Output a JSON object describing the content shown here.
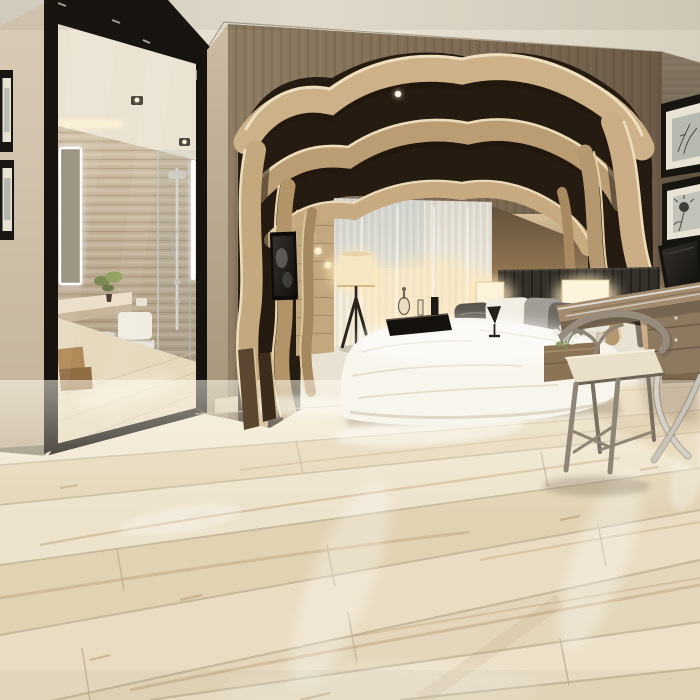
{
  "scene": {
    "type": "interior-photograph",
    "description": "Modern hotel-style bedroom showcasing wide light-oak plank flooring, with a sculptural layered wood arch framing the bed alcove, a black-framed opening revealing an en-suite bathroom, a wooden writing desk with laptop and wishbone chair, and warm accent lighting",
    "room": "bedroom with en-suite bathroom view",
    "style": "contemporary organic wood design",
    "lighting": [
      "warm recessed ceiling downlights",
      "glowing rectangular bedside lamps",
      "tripod floor lamp with fabric shade",
      "LED backlit bathroom mirror",
      "vertical LED strip in shower area"
    ],
    "palette": {
      "ceiling": "#e8e1d2",
      "left_wall": "#cdbfa8",
      "wood_feature_wall": "#83705a",
      "right_wall": "#675b4c",
      "arch_wood_light": "#c9ad85",
      "arch_wood_mid": "#b29468",
      "arch_void_dark": "#261b10",
      "arch_edge_highlight": "#eee0bf",
      "mirror_frame_black": "#17130f",
      "bathroom_travertine": "#bfae94",
      "bathroom_ceiling": "#ebe3d2",
      "curtain_sheer": "#efe8da",
      "headboard_charcoal": "#34302a",
      "bedding_white": "#f8f5ed",
      "lamp_glow_warm": "#fdf3d9",
      "desk_wood": "#a28b6e",
      "chair_wood_taupe": "#8f8577",
      "chrome_metal": "#d6d2ca",
      "floor_plank_light": "#efe6d0",
      "floor_plank_tan": "#e1d2b2",
      "floor_grain": "#ab8d62",
      "floor_seam": "#c3b69a"
    },
    "floor": {
      "material": "wide-plank wood-look flooring, glossy finish",
      "plank_direction": "diagonal, rising toward right vanishing point",
      "visible_seams": 8,
      "visible_end_joints": 8
    },
    "objects": [
      {
        "name": "framed-wall-art-left",
        "count": 2,
        "note": "black frames, cream mats, clipped at left edge"
      },
      {
        "name": "mirror-doorway-to-bathroom",
        "note": "tall black-framed opening"
      },
      {
        "name": "bathroom-vanity",
        "note": "cream stone counter"
      },
      {
        "name": "potted-plant",
        "note": "small green bonsai on counter"
      },
      {
        "name": "toilet",
        "note": "white, wall side"
      },
      {
        "name": "pedal-trash-can",
        "note": "stainless steel"
      },
      {
        "name": "walk-in-shower",
        "note": "glass panel, chrome shower column"
      },
      {
        "name": "led-mirror",
        "note": "glowing white outline"
      },
      {
        "name": "sculptural-wood-arch",
        "note": "nested wavy timber ribbons around bed alcove"
      },
      {
        "name": "sheer-curtain",
        "note": "backlit warm white"
      },
      {
        "name": "tripod-floor-lamp",
        "note": "beige glowing shade, black legs"
      },
      {
        "name": "wall-tv",
        "note": "small dark screen on arch leg"
      },
      {
        "name": "wall-sconces",
        "count": 3,
        "note": "tiny glowing lamps on padded column"
      },
      {
        "name": "bed-with-white-duvet",
        "note": "low platform bed"
      },
      {
        "name": "pillows",
        "count": 6,
        "note": "white, gray and charcoal mix"
      },
      {
        "name": "serving-tray",
        "note": "dark tray with decanter and glasses on bed"
      },
      {
        "name": "goblet",
        "note": "dark glass on duvet"
      },
      {
        "name": "headboard",
        "note": "charcoal channel-tufted"
      },
      {
        "name": "bedside-lamps",
        "count": 2,
        "note": "glowing rectangular shades"
      },
      {
        "name": "nightstand",
        "note": "wood, partially hidden"
      },
      {
        "name": "white-flowers",
        "note": "small posy by bed"
      },
      {
        "name": "writing-desk",
        "note": "wood slat top, chrome X legs, drawer unit"
      },
      {
        "name": "laptop",
        "note": "open, dark screen"
      },
      {
        "name": "wishbone-chair",
        "note": "taupe wood frame, cream seat cushion"
      },
      {
        "name": "framed-botanical-prints",
        "count": 2,
        "note": "stacked on right wall"
      }
    ]
  }
}
